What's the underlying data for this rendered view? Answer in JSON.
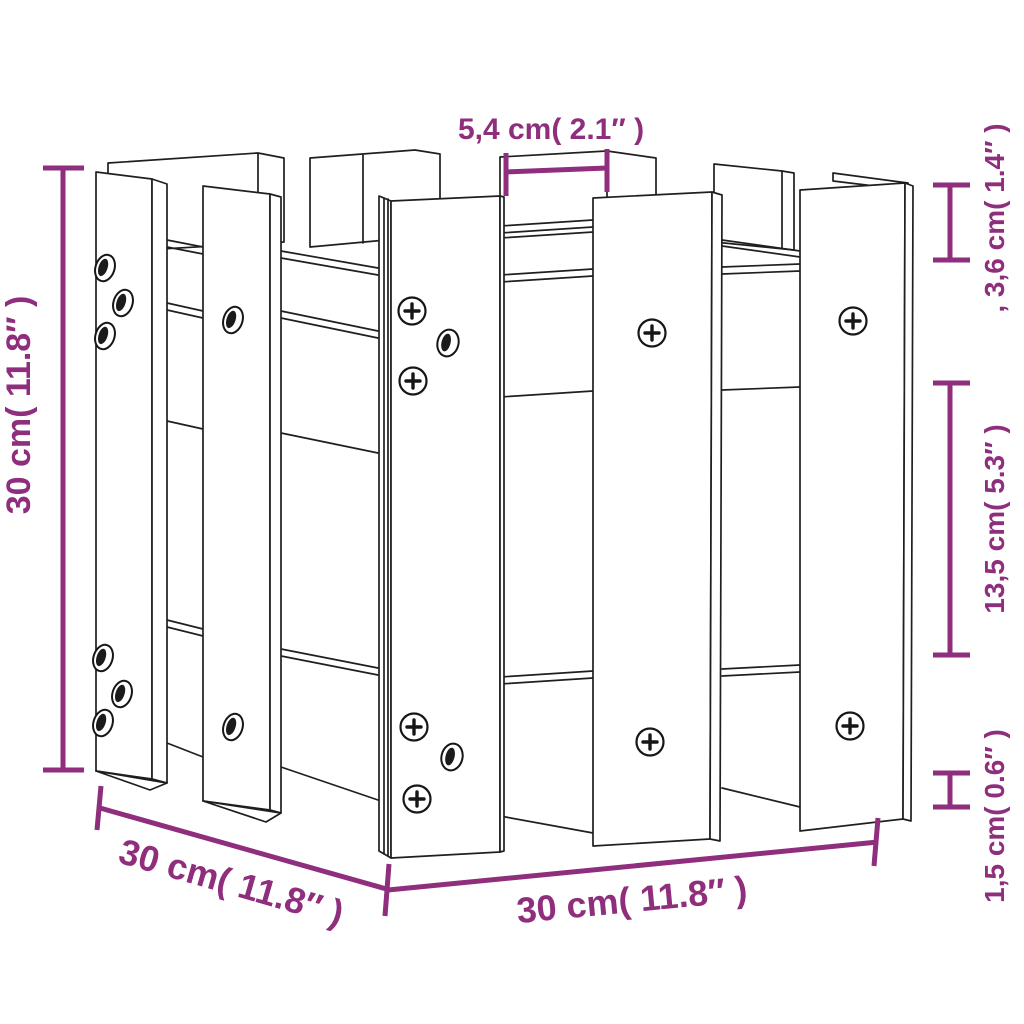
{
  "figure": {
    "kind": "product-dimension-diagram",
    "subject": "fence-style garden planter line drawing"
  },
  "style": {
    "accent_color": "#8e2e7d",
    "ink_color": "#1f1f1f",
    "background_color": "#ffffff"
  },
  "dimensions": {
    "top": {
      "label": "5,4 cm( 2.1″ )"
    },
    "right_top": {
      "label": ", 3,6 cm( 1.4″ )"
    },
    "right_middle": {
      "label": "13,5 cm( 5.3″ )"
    },
    "right_bottom": {
      "label": "1,5 cm( 0.6″ )"
    },
    "left": {
      "label": "30 cm( 11.8″ )"
    },
    "bottom_left": {
      "label": "30 cm( 11.8″ )"
    },
    "bottom_center": {
      "label": "30 cm( 11.8″ )"
    }
  }
}
